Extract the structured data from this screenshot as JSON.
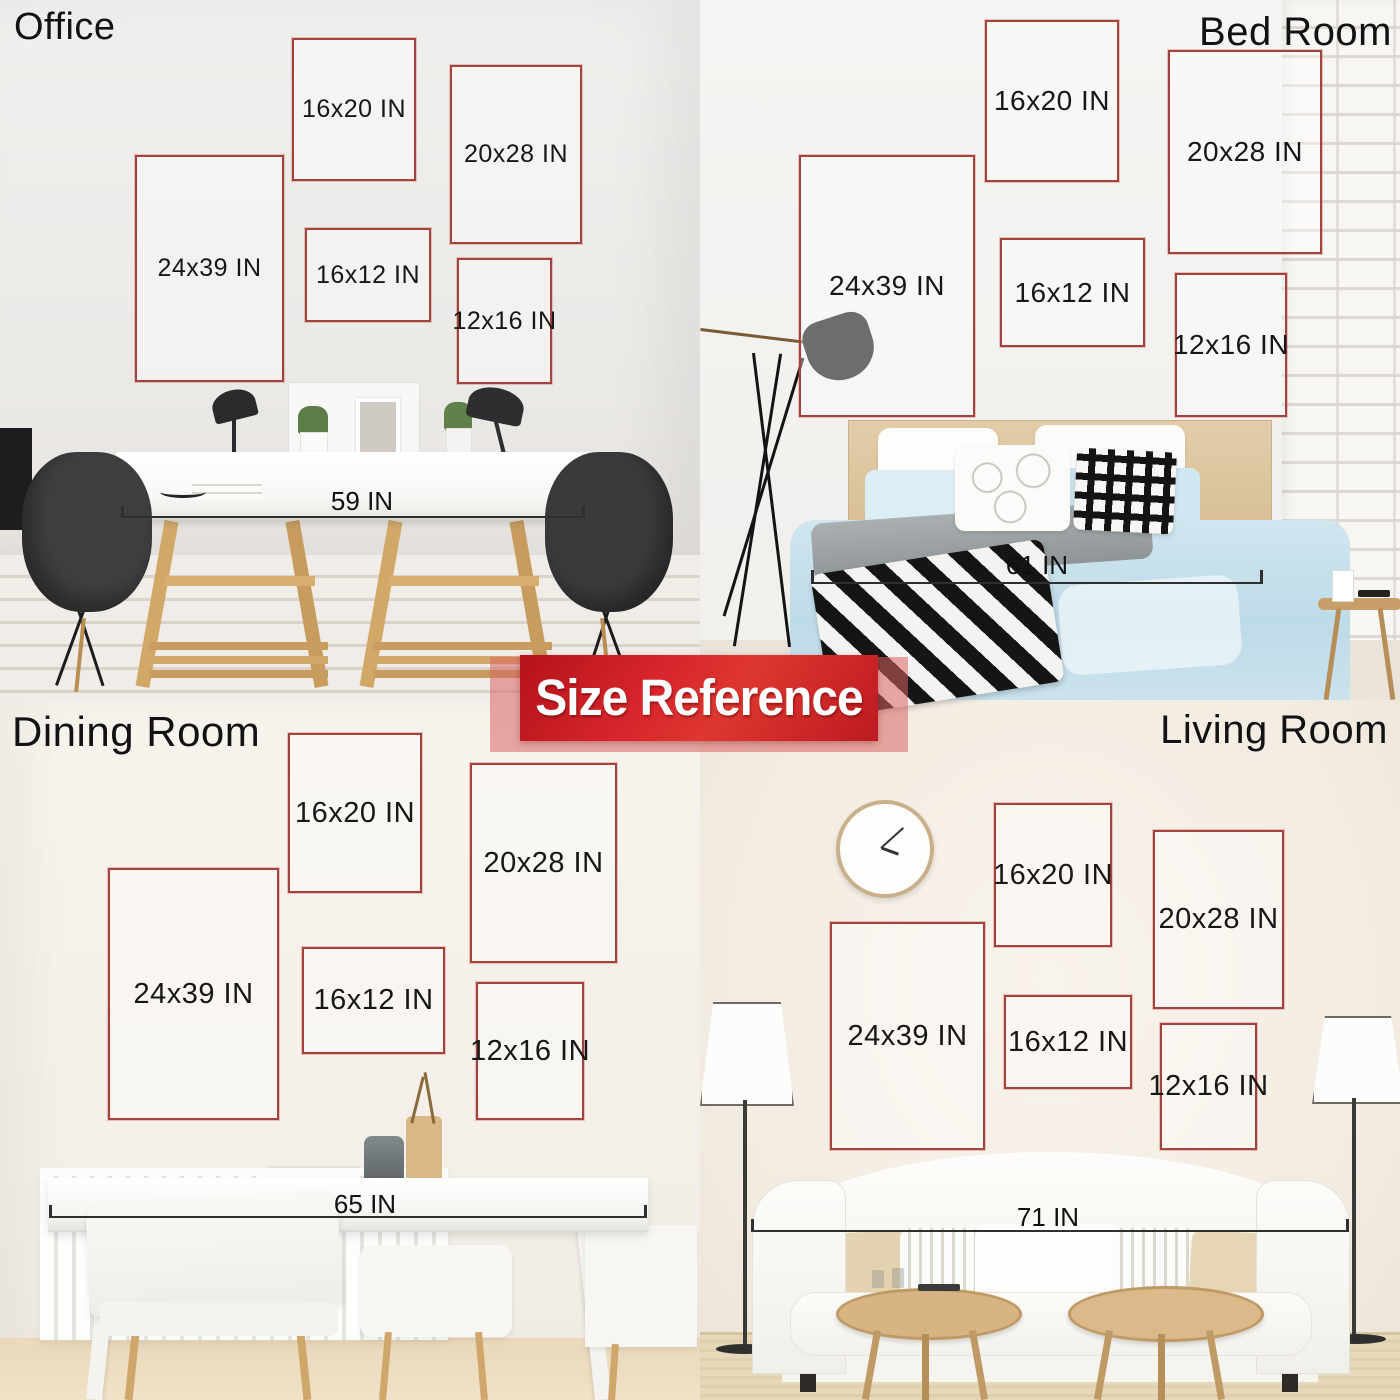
{
  "banner": {
    "label": "Size Reference"
  },
  "colors": {
    "frame-border": "#a6423b",
    "label-text": "#171717",
    "measure-line": "#2f2f2f",
    "banner-red": "#cc2127",
    "banner-red-dark": "#a8161c"
  },
  "rooms": [
    {
      "name": "Office",
      "furniture_width": "59 IN",
      "frames": [
        {
          "label": "16x20 IN"
        },
        {
          "label": "20x28 IN"
        },
        {
          "label": "24x39 IN"
        },
        {
          "label": "16x12 IN"
        },
        {
          "label": "12x16 IN"
        }
      ]
    },
    {
      "name": "Bed Room",
      "furniture_width": "61 IN",
      "frames": [
        {
          "label": "16x20 IN"
        },
        {
          "label": "20x28 IN"
        },
        {
          "label": "24x39 IN"
        },
        {
          "label": "16x12 IN"
        },
        {
          "label": "12x16 IN"
        }
      ]
    },
    {
      "name": "Dining Room",
      "furniture_width": "65 IN",
      "frames": [
        {
          "label": "16x20 IN"
        },
        {
          "label": "20x28 IN"
        },
        {
          "label": "24x39 IN"
        },
        {
          "label": "16x12 IN"
        },
        {
          "label": "12x16 IN"
        }
      ]
    },
    {
      "name": "Living Room",
      "furniture_width": "71 IN",
      "frames": [
        {
          "label": "16x20 IN"
        },
        {
          "label": "20x28 IN"
        },
        {
          "label": "24x39 IN"
        },
        {
          "label": "16x12 IN"
        },
        {
          "label": "12x16 IN"
        }
      ]
    }
  ]
}
